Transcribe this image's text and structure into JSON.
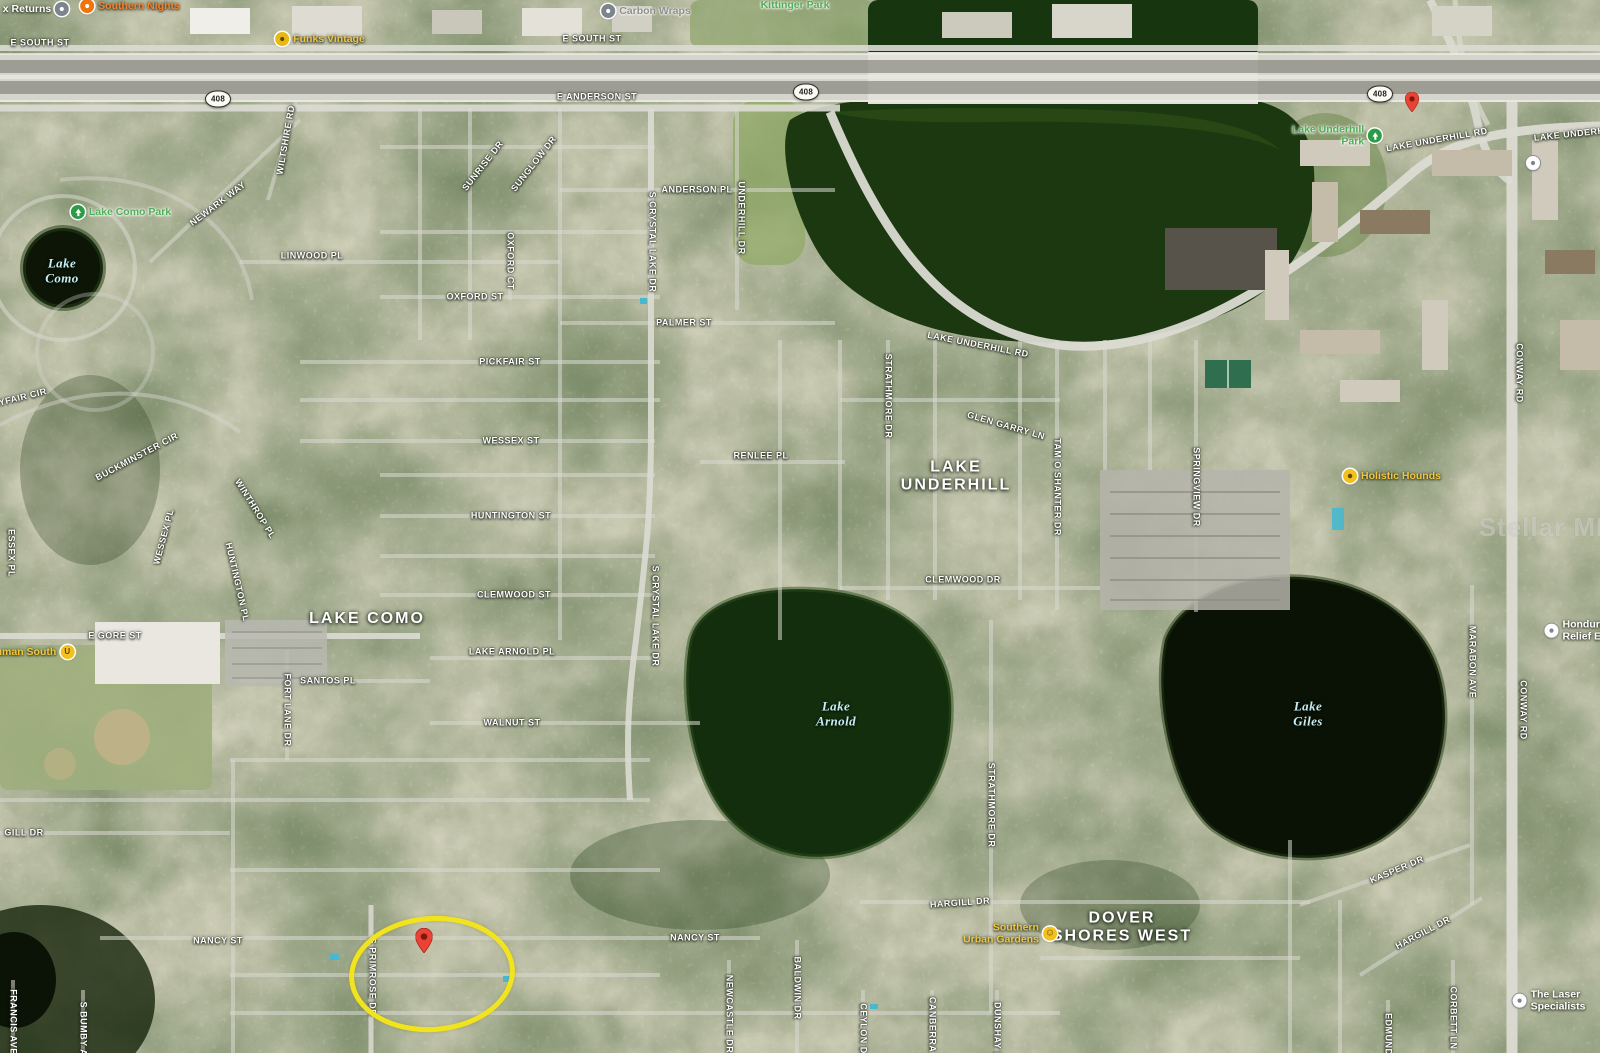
{
  "map": {
    "watermark": "Stellar MLS",
    "highlight_ellipse": {
      "cx": 427,
      "cy": 969,
      "rx": 78,
      "ry": 53,
      "color": "#f2e41c"
    },
    "pins": [
      {
        "name": "highlighted-home-pin",
        "x": 424,
        "y": 958,
        "w": 17
      },
      {
        "name": "lake-underhill-park-pin",
        "x": 1412,
        "y": 117,
        "w": 14
      }
    ],
    "route_shields": [
      {
        "label": "408",
        "x": 218,
        "y": 99
      },
      {
        "label": "408",
        "x": 806,
        "y": 92
      },
      {
        "label": "408",
        "x": 1380,
        "y": 94
      }
    ],
    "area_labels": [
      {
        "lines": [
          "LAKE COMO"
        ],
        "x": 367,
        "y": 619
      },
      {
        "lines": [
          "LAKE",
          "UNDERHILL"
        ],
        "x": 956,
        "y": 477
      },
      {
        "lines": [
          "DOVER",
          "SHORES WEST"
        ],
        "x": 1122,
        "y": 928
      }
    ],
    "lake_labels": [
      {
        "lines": [
          "Lake",
          "Como"
        ],
        "x": 62,
        "y": 271
      },
      {
        "lines": [
          "Lake",
          "Arnold"
        ],
        "x": 836,
        "y": 714
      },
      {
        "lines": [
          "Lake",
          "Giles"
        ],
        "x": 1308,
        "y": 714
      }
    ],
    "street_labels": [
      {
        "text": "E SOUTH ST",
        "x": 40,
        "y": 43,
        "rot": 0
      },
      {
        "text": "E SOUTH ST",
        "x": 592,
        "y": 39,
        "rot": 0
      },
      {
        "text": "E ANDERSON ST",
        "x": 597,
        "y": 97,
        "rot": 0
      },
      {
        "text": "LAKE UNDERHILL RD",
        "x": 1437,
        "y": 140,
        "rot": -10
      },
      {
        "text": "LAKE UNDERHILL RD",
        "x": 1585,
        "y": 133,
        "rot": -6
      },
      {
        "text": "LAKE UNDERHILL RD",
        "x": 978,
        "y": 345,
        "rot": 11
      },
      {
        "text": "ANDERSON PL",
        "x": 697,
        "y": 190,
        "rot": 0
      },
      {
        "text": "UNDERHILL DR",
        "x": 741,
        "y": 218,
        "rot": 90
      },
      {
        "text": "S CRYSTAL LAKE DR",
        "x": 652,
        "y": 242,
        "rot": 90
      },
      {
        "text": "OXFORD CT",
        "x": 510,
        "y": 261,
        "rot": 90
      },
      {
        "text": "OXFORD ST",
        "x": 475,
        "y": 297,
        "rot": 0
      },
      {
        "text": "PALMER ST",
        "x": 684,
        "y": 323,
        "rot": 0
      },
      {
        "text": "PICKFAIR ST",
        "x": 510,
        "y": 362,
        "rot": 0
      },
      {
        "text": "SUNRISE DR",
        "x": 483,
        "y": 166,
        "rot": -52
      },
      {
        "text": "SUNGLOW DR",
        "x": 534,
        "y": 164,
        "rot": -52
      },
      {
        "text": "NEWARK WAY",
        "x": 218,
        "y": 204,
        "rot": -37
      },
      {
        "text": "WILTSHIRE RD",
        "x": 286,
        "y": 140,
        "rot": -80
      },
      {
        "text": "LINWOOD PL",
        "x": 312,
        "y": 256,
        "rot": 0
      },
      {
        "text": "MAYFAIR CIR",
        "x": 16,
        "y": 399,
        "rot": -14
      },
      {
        "text": "BUCKMINSTER CIR",
        "x": 137,
        "y": 457,
        "rot": -28
      },
      {
        "text": "WESSEX ST",
        "x": 511,
        "y": 441,
        "rot": 0
      },
      {
        "text": "WESSEX PL",
        "x": 164,
        "y": 537,
        "rot": -75
      },
      {
        "text": "WINTHROP PL",
        "x": 255,
        "y": 509,
        "rot": 58
      },
      {
        "text": "HUNTINGTON PL",
        "x": 237,
        "y": 582,
        "rot": 77
      },
      {
        "text": "HUNTINGTON ST",
        "x": 511,
        "y": 516,
        "rot": 0
      },
      {
        "text": "ESSEX PL",
        "x": 11,
        "y": 553,
        "rot": 90
      },
      {
        "text": "CLEMWOOD ST",
        "x": 514,
        "y": 595,
        "rot": 0
      },
      {
        "text": "E GORE ST",
        "x": 115,
        "y": 636,
        "rot": 0
      },
      {
        "text": "RENLEE PL",
        "x": 761,
        "y": 456,
        "rot": 0
      },
      {
        "text": "GLEN GARRY LN",
        "x": 1006,
        "y": 426,
        "rot": 16
      },
      {
        "text": "STRATHMORE DR",
        "x": 888,
        "y": 396,
        "rot": 90
      },
      {
        "text": "TAM O SHANTER DR",
        "x": 1057,
        "y": 487,
        "rot": 90
      },
      {
        "text": "SPRINGVIEW DR",
        "x": 1196,
        "y": 487,
        "rot": 90
      },
      {
        "text": "CLEMWOOD DR",
        "x": 963,
        "y": 580,
        "rot": 0
      },
      {
        "text": "S CRYSTAL LAKE DR",
        "x": 655,
        "y": 616,
        "rot": 90
      },
      {
        "text": "LAKE ARNOLD PL",
        "x": 512,
        "y": 652,
        "rot": 0
      },
      {
        "text": "SANTOS PL",
        "x": 328,
        "y": 681,
        "rot": 0
      },
      {
        "text": "FORT LANE DR",
        "x": 287,
        "y": 710,
        "rot": 90
      },
      {
        "text": "WALNUT ST",
        "x": 512,
        "y": 723,
        "rot": 0
      },
      {
        "text": "STRATHMORE DR",
        "x": 991,
        "y": 805,
        "rot": 90
      },
      {
        "text": "MARABON AVE",
        "x": 1472,
        "y": 662,
        "rot": 90
      },
      {
        "text": "CONWAY RD",
        "x": 1519,
        "y": 373,
        "rot": 90
      },
      {
        "text": "CONWAY RD",
        "x": 1523,
        "y": 710,
        "rot": 90
      },
      {
        "text": "GILL DR",
        "x": 24,
        "y": 833,
        "rot": 0
      },
      {
        "text": "NANCY ST",
        "x": 218,
        "y": 941,
        "rot": 0
      },
      {
        "text": "NANCY ST",
        "x": 695,
        "y": 938,
        "rot": 0
      },
      {
        "text": "HARGILL DR",
        "x": 960,
        "y": 903,
        "rot": -4
      },
      {
        "text": "HARGILL DR",
        "x": 1423,
        "y": 933,
        "rot": -28
      },
      {
        "text": "KASPER DR",
        "x": 1397,
        "y": 870,
        "rot": -23
      },
      {
        "text": "S PRIMROSE DR",
        "x": 372,
        "y": 977,
        "rot": 90
      },
      {
        "text": "NEWCASTLE DR",
        "x": 729,
        "y": 1014,
        "rot": 90
      },
      {
        "text": "BALDWIN DR",
        "x": 797,
        "y": 988,
        "rot": 90
      },
      {
        "text": "CEYLON DR",
        "x": 863,
        "y": 1032,
        "rot": 90
      },
      {
        "text": "CANBERRA RD",
        "x": 932,
        "y": 1033,
        "rot": 90
      },
      {
        "text": "DUNSHAY DR",
        "x": 997,
        "y": 1034,
        "rot": 90
      },
      {
        "text": "CORBETT LN",
        "x": 1453,
        "y": 1018,
        "rot": 90
      },
      {
        "text": "EDMUND ST",
        "x": 1388,
        "y": 1042,
        "rot": 90
      },
      {
        "text": "FRANCIS AVE",
        "x": 13,
        "y": 1022,
        "rot": 90
      },
      {
        "text": "S BUMBY AVE",
        "x": 83,
        "y": 1035,
        "rot": 90
      }
    ],
    "poi_labels": [
      {
        "name": "x-returns",
        "lines": [
          "x Returns"
        ],
        "x": 36,
        "y": 9,
        "color": "white",
        "icon": "gray",
        "side": "right"
      },
      {
        "name": "southern-nights",
        "lines": [
          "Southern Nights"
        ],
        "x": 130,
        "y": 6,
        "color": "orange",
        "icon": "orange",
        "side": "left"
      },
      {
        "name": "funks-vintage",
        "lines": [
          "Funks Vintage"
        ],
        "x": 320,
        "y": 39,
        "color": "yellow",
        "icon": "yellowdot",
        "side": "left"
      },
      {
        "name": "carbon-wraps",
        "lines": [
          "Carbon Wraps"
        ],
        "x": 646,
        "y": 11,
        "color": "gray",
        "icon": "gray",
        "side": "left"
      },
      {
        "name": "kittinger-park",
        "lines": [
          "Kittinger Park"
        ],
        "x": 795,
        "y": 5,
        "color": "green",
        "icon": "none",
        "side": "left"
      },
      {
        "name": "lake-como-park",
        "lines": [
          "Lake Como Park"
        ],
        "x": 121,
        "y": 212,
        "color": "green",
        "icon": "tree",
        "side": "left"
      },
      {
        "name": "lake-underhill-park",
        "lines": [
          "Lake Underhill",
          "Park"
        ],
        "x": 1337,
        "y": 136,
        "color": "green",
        "icon": "tree",
        "side": "right",
        "align": "right"
      },
      {
        "name": "holistic-hounds",
        "lines": [
          "Holistic Hounds"
        ],
        "x": 1392,
        "y": 476,
        "color": "yellow",
        "icon": "dog",
        "side": "left"
      },
      {
        "name": "truman-south",
        "lines": [
          "Truman South"
        ],
        "x": 30,
        "y": 652,
        "color": "yellow",
        "icon": "u",
        "side": "right"
      },
      {
        "name": "southern-urban-gardens",
        "lines": [
          "Southern",
          "Urban Gardens"
        ],
        "x": 1010,
        "y": 934,
        "color": "yellow",
        "icon": "smiley",
        "side": "right",
        "align": "right"
      },
      {
        "name": "honduras-relief",
        "lines": [
          "Honduras",
          "Relief Eff"
        ],
        "x": 1578,
        "y": 631,
        "color": "white",
        "icon": "white",
        "side": "left"
      },
      {
        "name": "the-laser-specialists",
        "lines": [
          "The Laser",
          "Specialists"
        ],
        "x": 1549,
        "y": 1001,
        "color": "white",
        "icon": "white",
        "side": "left"
      },
      {
        "name": "unnamed-poi",
        "lines": [],
        "x": 1533,
        "y": 163,
        "color": "white",
        "icon": "white",
        "side": "left"
      }
    ]
  }
}
